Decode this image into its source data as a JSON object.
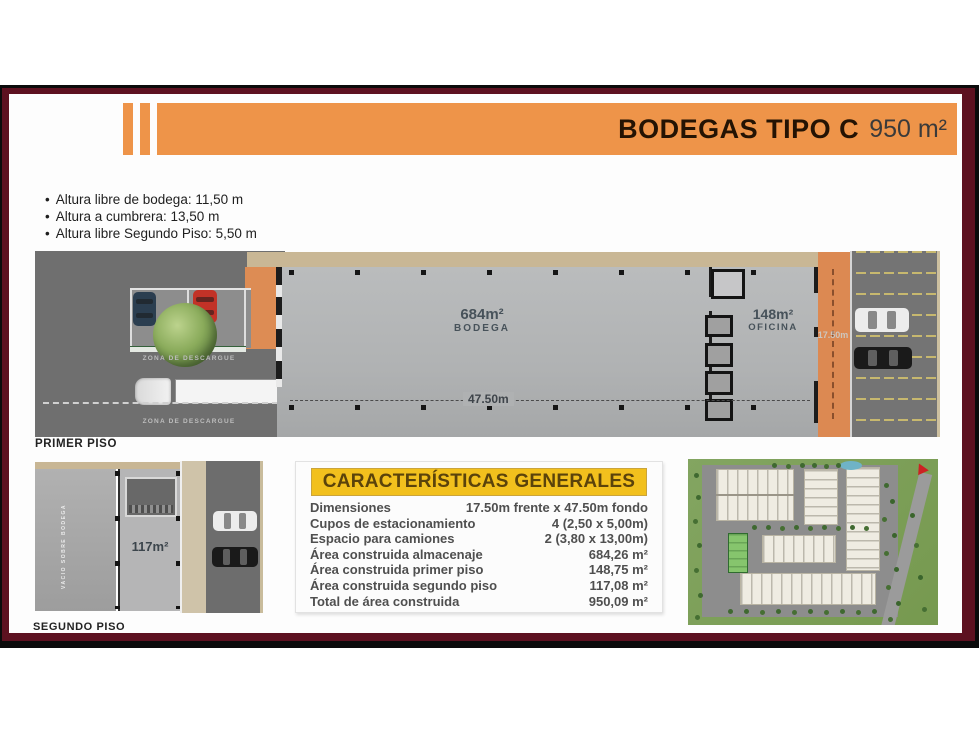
{
  "header": {
    "title_bold": "BODEGAS TIPO C",
    "title_area": "950 m²"
  },
  "specs": {
    "bullet": "•",
    "items": [
      "Altura libre de bodega: 11,50 m",
      "Altura a cumbrera: 13,50 m",
      "Altura libre Segundo Piso: 5,50 m"
    ]
  },
  "first_floor": {
    "label": "PRIMER PISO",
    "zona_descargue": "ZONA DE DESCARGUE",
    "bodega_area": "684m²",
    "bodega_label": "BODEGA",
    "oficina_area": "148m²",
    "oficina_label": "OFICINA",
    "depth_dim": "47.50m",
    "front_dim": "17.50m"
  },
  "second_floor": {
    "label": "SEGUNDO PISO",
    "area": "117m²",
    "vertical_note": "VACIO SOBRE BODEGA"
  },
  "table": {
    "title": "CARACTERÍSTICAS GENERALES",
    "rows": [
      {
        "label": "Dimensiones",
        "value": "17.50m frente x 47.50m fondo"
      },
      {
        "label": "Cupos de estacionamiento",
        "value": "4 (2,50 x 5,00m)"
      },
      {
        "label": "Espacio para camiones",
        "value": "2 (3,80 x 13,00m)"
      },
      {
        "label": "Área construida almacenaje",
        "value": "684,26 m²"
      },
      {
        "label": "Área construida primer piso",
        "value": "148,75 m²"
      },
      {
        "label": "Área construida segundo piso",
        "value": "117,08 m²"
      },
      {
        "label": "Total de área construida",
        "value": "950,09 m²"
      }
    ]
  },
  "colors": {
    "accent_orange": "#ee9449",
    "plan_orange": "#dc8952",
    "frame_maroon": "#5d1120",
    "table_yellow": "#f2c01d",
    "wall_tan": "#c9b795",
    "highlight_green": "#86c56d"
  }
}
